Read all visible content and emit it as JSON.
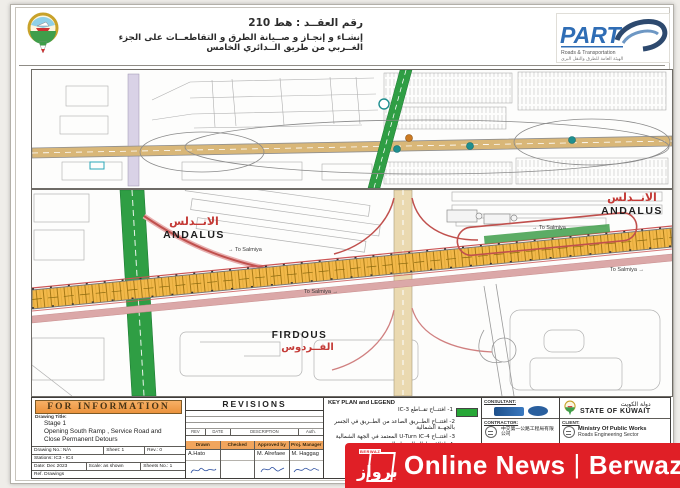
{
  "header": {
    "contract_line": "رقم العقــد : هط 210",
    "project_line": "إنشـاء و إنجـاز و صــيانة الطرق و التقاطعــات على الجزء الغــربي من طريق الــدائري الخامس",
    "part_logo": {
      "text": "PART",
      "sub_en": "Roads & Transportation",
      "sub_ar": "الهيئة العامة للطرق والنقل البري"
    }
  },
  "icons": {
    "arrow_right": "→"
  },
  "map_lower": {
    "andalus_ar": "الانــدلس",
    "andalus_en": "ANDALUS",
    "andalus_right_ar": "الانــدلس",
    "andalus_right_en": "ANDALUS",
    "firdous_en": "FIRDOUS",
    "firdous_ar": "الفــردوس",
    "to_label": "To Salmiya"
  },
  "title_block": {
    "for_information": "FOR INFORMATION",
    "drawing_title_label": "Drawing Title:",
    "title_lines": [
      "Stage 1",
      "Opening South Ramp , Service Road and",
      "Close Permanent Detours"
    ],
    "drawing_no": "Drawing No.: N/A",
    "sheet": "Sheet: 1",
    "rev": "Rev.: 0",
    "stations": "Stations: IC3 - IC4",
    "date": "Date: Dec 2023",
    "scale": "Scale: as shown",
    "sheets_no": "Sheets No.: 1",
    "ref_drawings": "Ref. Drawings",
    "revisions": {
      "header": "REVISIONS",
      "columns": [
        "REV",
        "DATE",
        "DESCRIPTION",
        "Auth."
      ],
      "roles": [
        "Drawn",
        "Checked",
        "Approved by",
        "Proj. Manager"
      ],
      "names": [
        "A.Hato",
        "",
        "M. Alrefaee",
        "M. Haggag"
      ]
    },
    "legend": {
      "header": "KEY PLAN and LEGEND",
      "items": [
        {
          "text": "1- افتتــاح تقــاطع IC-3",
          "swatch": "#27a737"
        },
        {
          "text": "2- افتتــاح الطــريق الصاعد من الطــريق في الجسر بالجهــة الشمالية",
          "swatch": ""
        },
        {
          "text": "3- افتتــاح U-Turn IC-4 المعتمد في الجهة الشمالية",
          "swatch": ""
        },
        {
          "text": "4- اغلاق و ازالة التحويلة المرورية",
          "swatch": "#e2392c"
        }
      ]
    },
    "consultant_label": "CONSULTANT:",
    "contractor_label": "CONTRACTOR:",
    "contractor_name": "中交第一公路工程局有限公司",
    "client_label": "CLIENT:",
    "state_ar": "دولة الكويت",
    "state_en": "STATE OF KUWAIT",
    "ministry": "Ministry Of Public Works",
    "sector": "Roads Engineering Sector"
  },
  "watermark": {
    "text_left": "Online News",
    "separator": "|",
    "text_right": "Berwaz",
    "logo_small": "BERWAZ",
    "logo_ar": "برواز"
  },
  "colors": {
    "highway_yellow": "#f2b84a",
    "corridor_tan": "#d9b778",
    "green_road": "#2f9e44",
    "ramp_red": "#c0504d",
    "legend_green": "#27a737",
    "legend_red": "#e2392c",
    "info_header_bg": "#f0a460",
    "watermark_bg": "#e01f26"
  }
}
